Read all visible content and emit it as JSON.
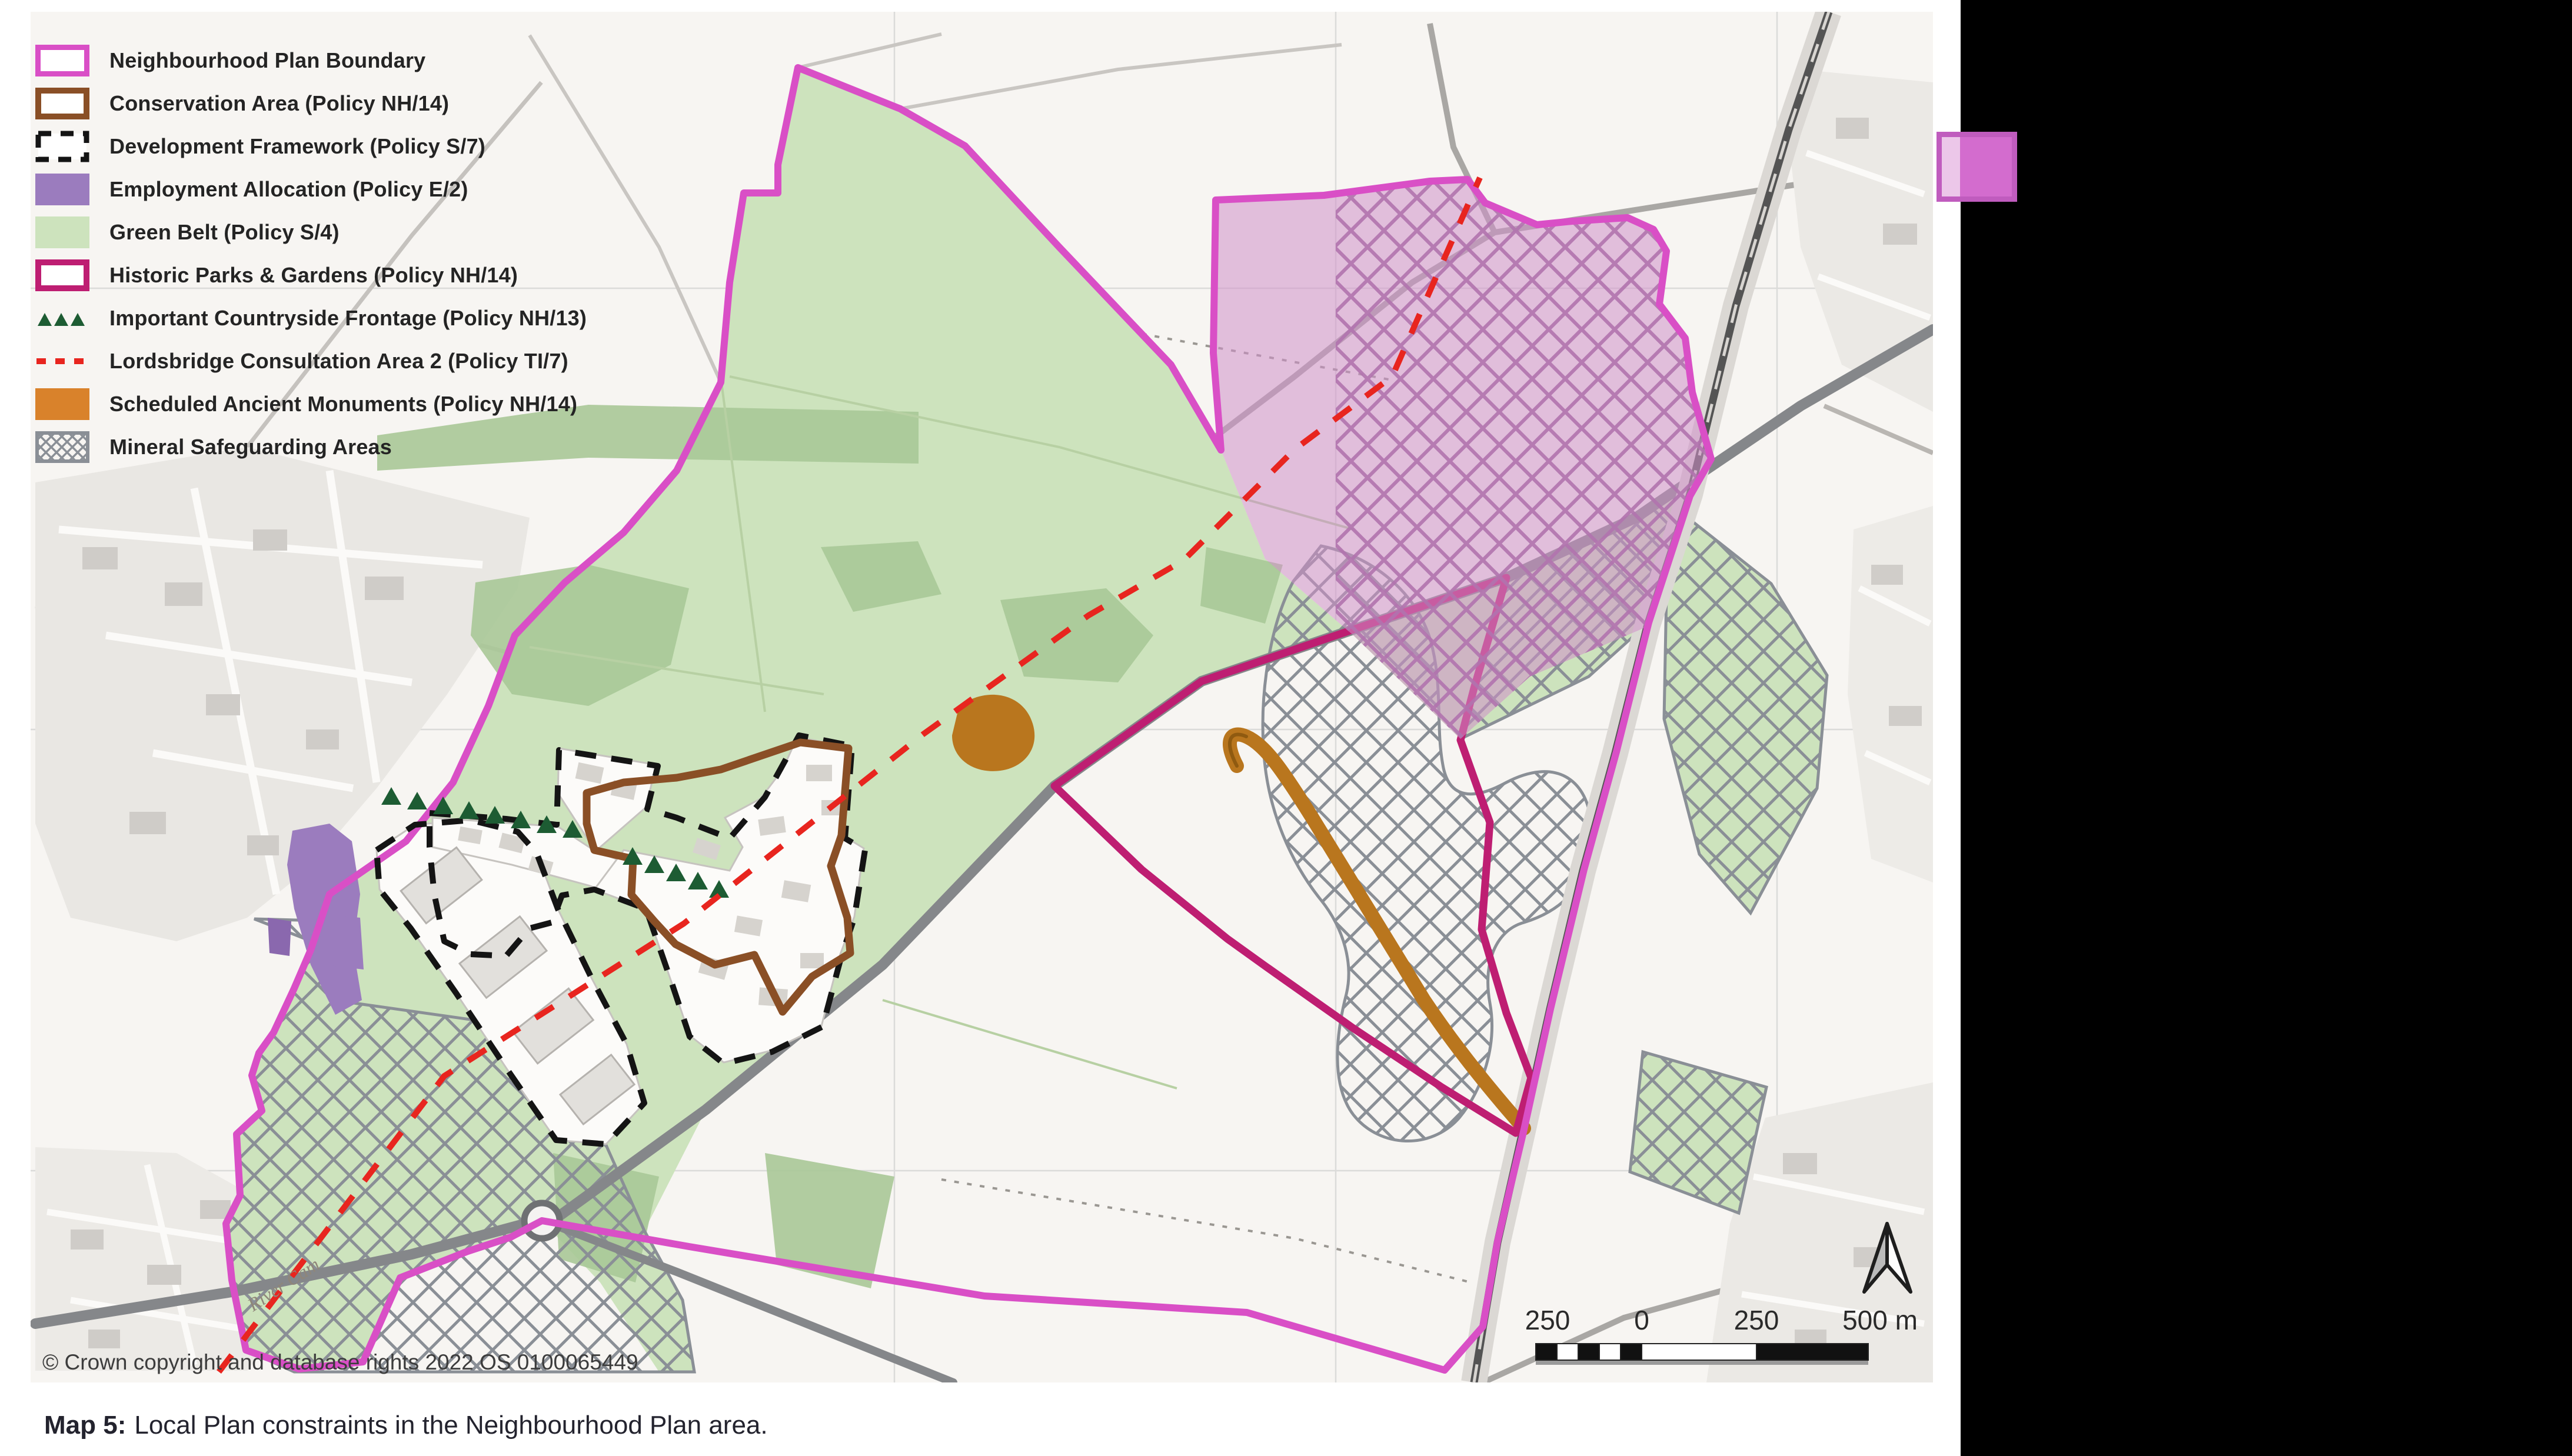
{
  "legend": {
    "items": [
      {
        "label": "Neighbourhood Plan Boundary",
        "swatch": "plan-boundary"
      },
      {
        "label": "Conservation Area (Policy NH/14)",
        "swatch": "conservation-area"
      },
      {
        "label": "Development Framework (Policy S/7)",
        "swatch": "development-framework"
      },
      {
        "label": "Employment Allocation (Policy E/2)",
        "swatch": "employment-allocation"
      },
      {
        "label": "Green Belt (Policy S/4)",
        "swatch": "green-belt"
      },
      {
        "label": "Historic Parks & Gardens (Policy NH/14)",
        "swatch": "historic-parks-gardens"
      },
      {
        "label": "Important Countryside Frontage (Policy NH/13)",
        "swatch": "countryside-frontage"
      },
      {
        "label": "Lordsbridge Consultation Area 2 (Policy TI/7)",
        "swatch": "lordsbridge-consultation"
      },
      {
        "label": "Scheduled Ancient Monuments (Policy NH/14)",
        "swatch": "ancient-monuments"
      },
      {
        "label": "Mineral Safeguarding Areas",
        "swatch": "mineral-safeguarding"
      }
    ]
  },
  "map": {
    "copyright": "© Crown copyright and database rights 2022 OS 0100065449",
    "scalebar": {
      "labels": [
        "250",
        "0",
        "250",
        "500 m"
      ]
    },
    "place_labels": {
      "river": "River Cam"
    }
  },
  "caption": {
    "prefix": "Map 5:",
    "text": "Local Plan constraints in the Neighbourhood Plan area."
  },
  "colors": {
    "plan_boundary": "#D94FC6",
    "conservation_area": "#8A4F26",
    "development_framework": "#141414",
    "employment_allocation": "#9B7CBE",
    "green_belt": "#CDE3BD",
    "historic_parks": "#BE1E72",
    "countryside_frontage": "#1D5C33",
    "lordsbridge_line": "#E8251F",
    "ancient_monuments": "#D9822B",
    "mineral_hatch": "#8A8F96",
    "page_marker_square": "#D36CCE",
    "offpage_region": "#000000"
  }
}
